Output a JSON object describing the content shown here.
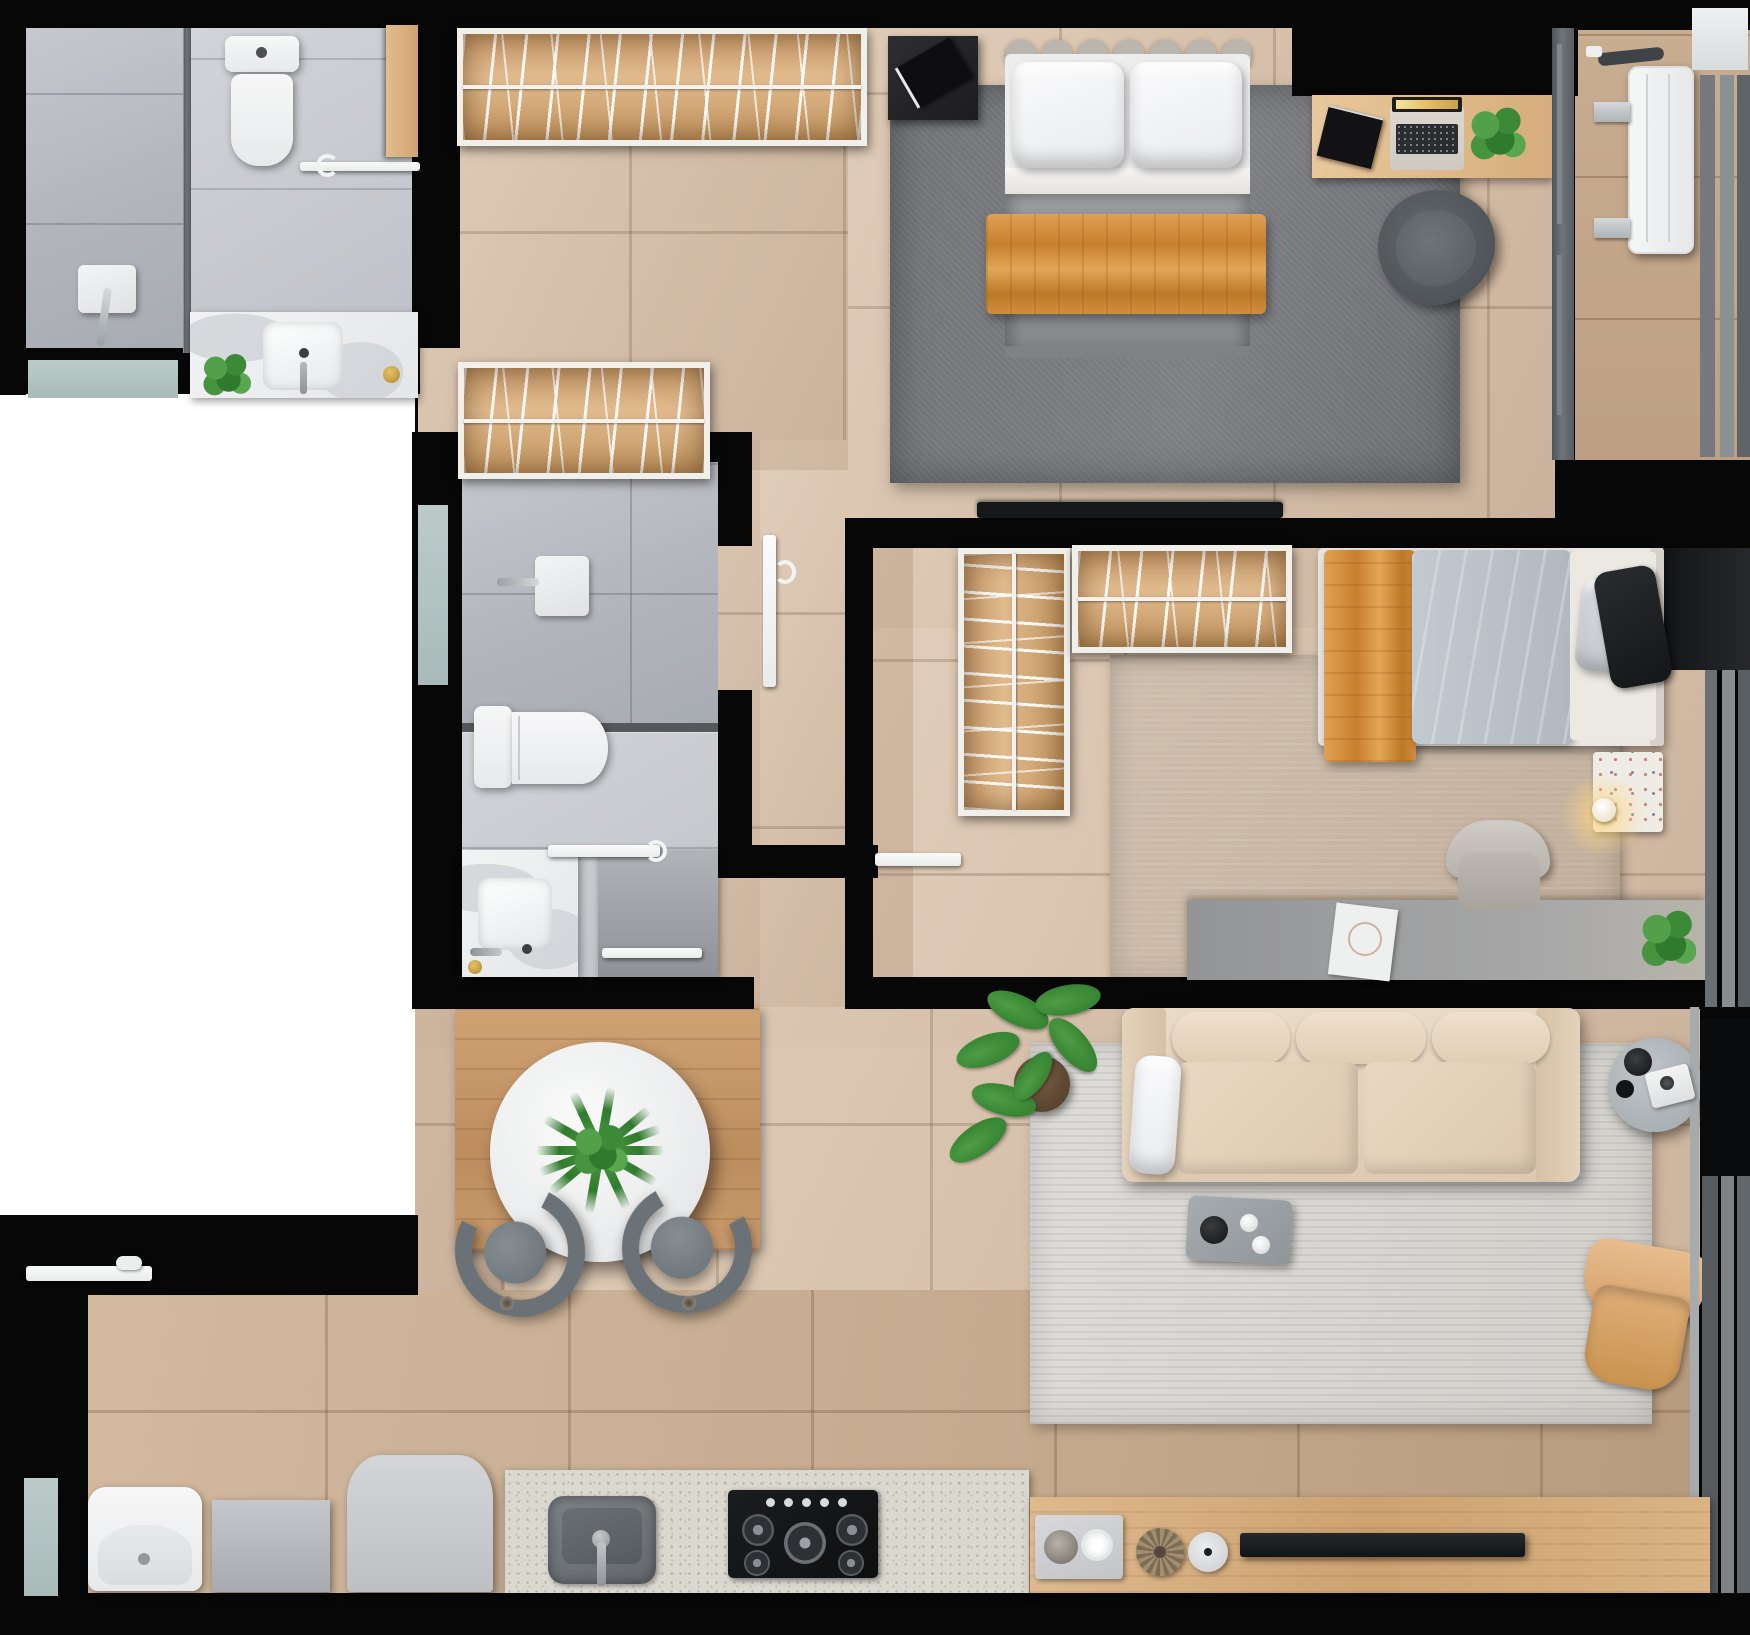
{
  "document": {
    "title": "Apartment floor plan – top-down 3D render",
    "type": "architectural floor plan, photorealistic top view",
    "canvas": {
      "width_px": 1750,
      "height_px": 1635
    }
  },
  "palette": {
    "wall": "#070707",
    "outside": "#ffffff",
    "floor_tile": "#d6c0ab",
    "kitchen_tile": "#c4a98d",
    "bathroom_tile": "#b2b5bc",
    "marble": "#eef0f1",
    "wood": "#cda271",
    "closet_wood": "#d5a877",
    "master_rug": "#76787b",
    "living_rug": "#d8d6d2",
    "bedroom2_rug": "#c7b6a4",
    "sofa_beige": "#e7d7c3",
    "throw_orange": "#cf8a3a",
    "duvet_gray": "#8f9194",
    "duvet_blue": "#bcc3ca",
    "armchair_tan": "#dfb083",
    "glass": "#5f6468",
    "window_sill": "#b5c4c3",
    "gold_accent": "#c9a23b",
    "plant_green": "#3f8f3a",
    "tv_black": "#16181a"
  },
  "rooms": {
    "bathroom1": {
      "label": "Bathroom (top left)",
      "items": [
        "walk-in shower",
        "glass shower partition",
        "wall shower mixer",
        "toilet",
        "marble vanity with sink",
        "potted plant",
        "towel bar",
        "wooden door leaf",
        "window sill"
      ]
    },
    "hall": {
      "label": "Dressing hall",
      "items": [
        "open wardrobe with hangers (upper)",
        "open wardrobe with hangers (lower)",
        "corridor",
        "white door leaf to bathroom",
        "white door leaf to bedroom 2"
      ]
    },
    "master": {
      "label": "Master bedroom",
      "items": [
        "double bed with scalloped headboard",
        "two white pillows",
        "gray duvet",
        "orange throw blanket",
        "black nightstand with book",
        "gray area rug",
        "wall-mounted TV",
        "wooden desk",
        "laptop",
        "black book",
        "desk plant",
        "gray swivel chair",
        "glass partition to service balcony"
      ]
    },
    "balcony": {
      "label": "Service balcony",
      "items": [
        "air-conditioner condenser unit",
        "wall brackets",
        "connection hose",
        "window frames"
      ]
    },
    "bathroom2": {
      "label": "Bathroom (middle)",
      "items": [
        "shower with wall mixer",
        "glass screen",
        "toilet",
        "marble vanity with sink",
        "door panel with towel bar",
        "window",
        "white glass screen bar"
      ]
    },
    "bedroom2": {
      "label": "Second bedroom",
      "items": [
        "single bed",
        "light blue duvet",
        "orange throw blanket",
        "gray pillow",
        "black pillow",
        "L-shaped open wardrobe with hangers",
        "terrazzo nightstand",
        "table lamp (lit)",
        "gray desk",
        "paper sheets",
        "desk plant",
        "light gray office chair",
        "beige rug",
        "window strip"
      ]
    },
    "dining": {
      "label": "Dining area",
      "items": [
        "round marble dining table",
        "green centerpiece plant",
        "gray dining chair (left)",
        "gray dining chair (right)",
        "wooden floor mat"
      ]
    },
    "living": {
      "label": "Living room",
      "items": [
        "three-seat beige sofa",
        "white armrest pillow",
        "light gray rug",
        "gray serving tray with remote and cups",
        "fiddle-leaf plant in pot",
        "round gray side table",
        "black bowls",
        "instant camera",
        "tan leather armchair",
        "balcony glazing"
      ]
    },
    "kitchen": {
      "label": "Kitchen / laundry",
      "items": [
        "granite counter",
        "undermount sink with faucet",
        "5-burner gas cooktop",
        "washing machine",
        "laundry box",
        "refrigerator with arched top",
        "wooden sideboard",
        "decor tray with bowls",
        "woven rosette",
        "white vase",
        "television",
        "entry door leaf",
        "window",
        "floor drains"
      ]
    }
  }
}
